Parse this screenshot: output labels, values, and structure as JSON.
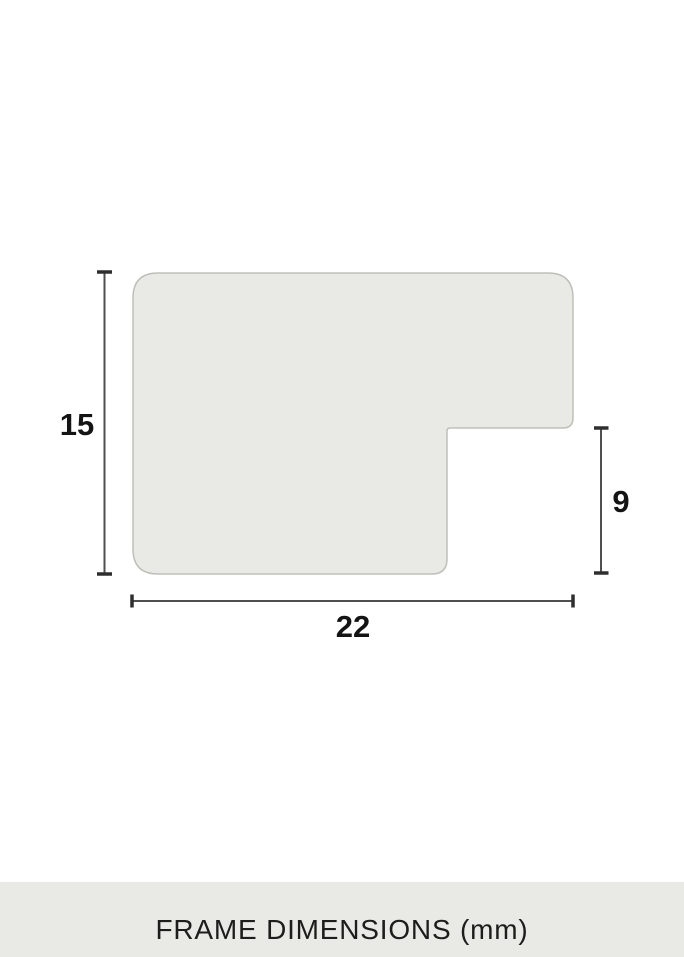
{
  "diagram": {
    "height_dimension": {
      "value": "15"
    },
    "notch_dimension": {
      "value": "9"
    },
    "width_dimension": {
      "value": "22"
    }
  },
  "footer": {
    "label": "FRAME DIMENSIONS (mm)"
  },
  "colors": {
    "page_bg": "#ffffff",
    "shape_fill": "#e9e9e5",
    "shape_border": "#bfbfba",
    "dim_line": "#4f4f4f",
    "dim_tick": "#2e2e2e",
    "label_text": "#141414",
    "footer_bg": "#e9e9e5",
    "footer_text": "#1d1d1b"
  }
}
